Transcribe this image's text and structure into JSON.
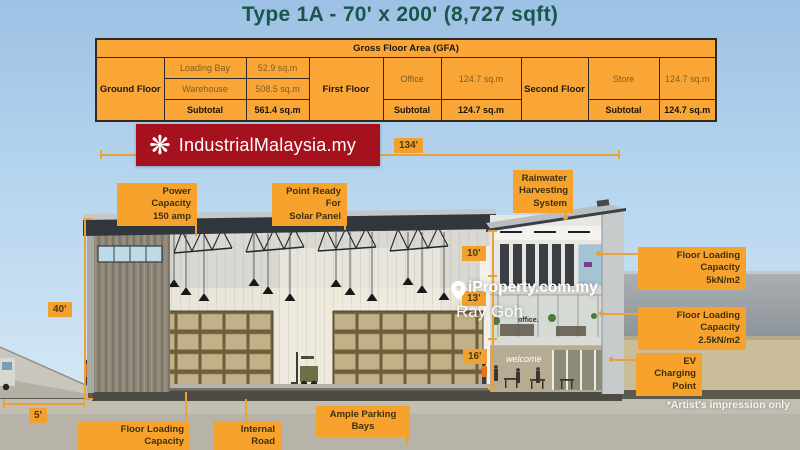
{
  "title": "Type 1A - 70' x 200' (8,727 sqft)",
  "gfa_table": {
    "header": "Gross Floor Area (GFA)",
    "ground": {
      "floor": "Ground Floor",
      "row1_label": "Loading Bay",
      "row1_value": "52.9 sq.m",
      "row2_label": "Warehouse",
      "row2_value": "508.5 sq.m",
      "subtotal_label": "Subtotal",
      "subtotal_value": "561.4 sq.m"
    },
    "first": {
      "floor": "First Floor",
      "row1_label": "Office",
      "row1_value": "124.7 sq.m",
      "subtotal_label": "Subtotal",
      "subtotal_value": "124.7 sq.m"
    },
    "second": {
      "floor": "Second Floor",
      "row1_label": "Store",
      "row1_value": "124.7 sq.m",
      "subtotal_label": "Subtotal",
      "subtotal_value": "124.7 sq.m"
    }
  },
  "logo": {
    "text": "IndustrialMalaysia.my",
    "icon": "flower-icon",
    "flower_glyph": "❋"
  },
  "dimensions": {
    "overall_width": "134'",
    "eave_height": "40'",
    "dock_width": "5'",
    "second_floor_height": "10'",
    "first_floor_height": "13'",
    "ground_floor_height": "16'"
  },
  "callouts": {
    "power_capacity": {
      "line1": "Power Capacity",
      "line2": "150 amp"
    },
    "solar_panel": {
      "line1": "Point Ready For",
      "line2": "Solar Panel"
    },
    "rainwater": {
      "line1": "Rainwater",
      "line2": "Harvesting",
      "line3": "System"
    },
    "floor_loading_5": {
      "line1": "Floor Loading Capacity",
      "line2": "5kN/m2"
    },
    "floor_loading_25": {
      "line1": "Floor Loading Capacity",
      "line2": "2.5kN/m2"
    },
    "ev_charging": {
      "line1": "EV Charging",
      "line2": "Point"
    },
    "floor_loading_15": {
      "line1": "Floor Loading Capacity",
      "line2": "15kN/m2"
    },
    "internal_road": {
      "line1": "Internal Road",
      "line2": "6 Metre"
    },
    "parking": {
      "line1": "Ample Parking Bays"
    }
  },
  "watermark": {
    "brand": "iProperty.com.my",
    "agent": "Ray Goh"
  },
  "disclaimer": "*Artist's impression only",
  "scene_signs": {
    "welcome_sign": "welcome",
    "office_sign": "office."
  },
  "colors": {
    "accent_orange": "#F6A22D",
    "table_orange": "#F9A637",
    "logo_red": "#A5121E",
    "title_green": "#1B564C",
    "label_text": "#3D3012",
    "dim_line": "#E9A23B"
  }
}
